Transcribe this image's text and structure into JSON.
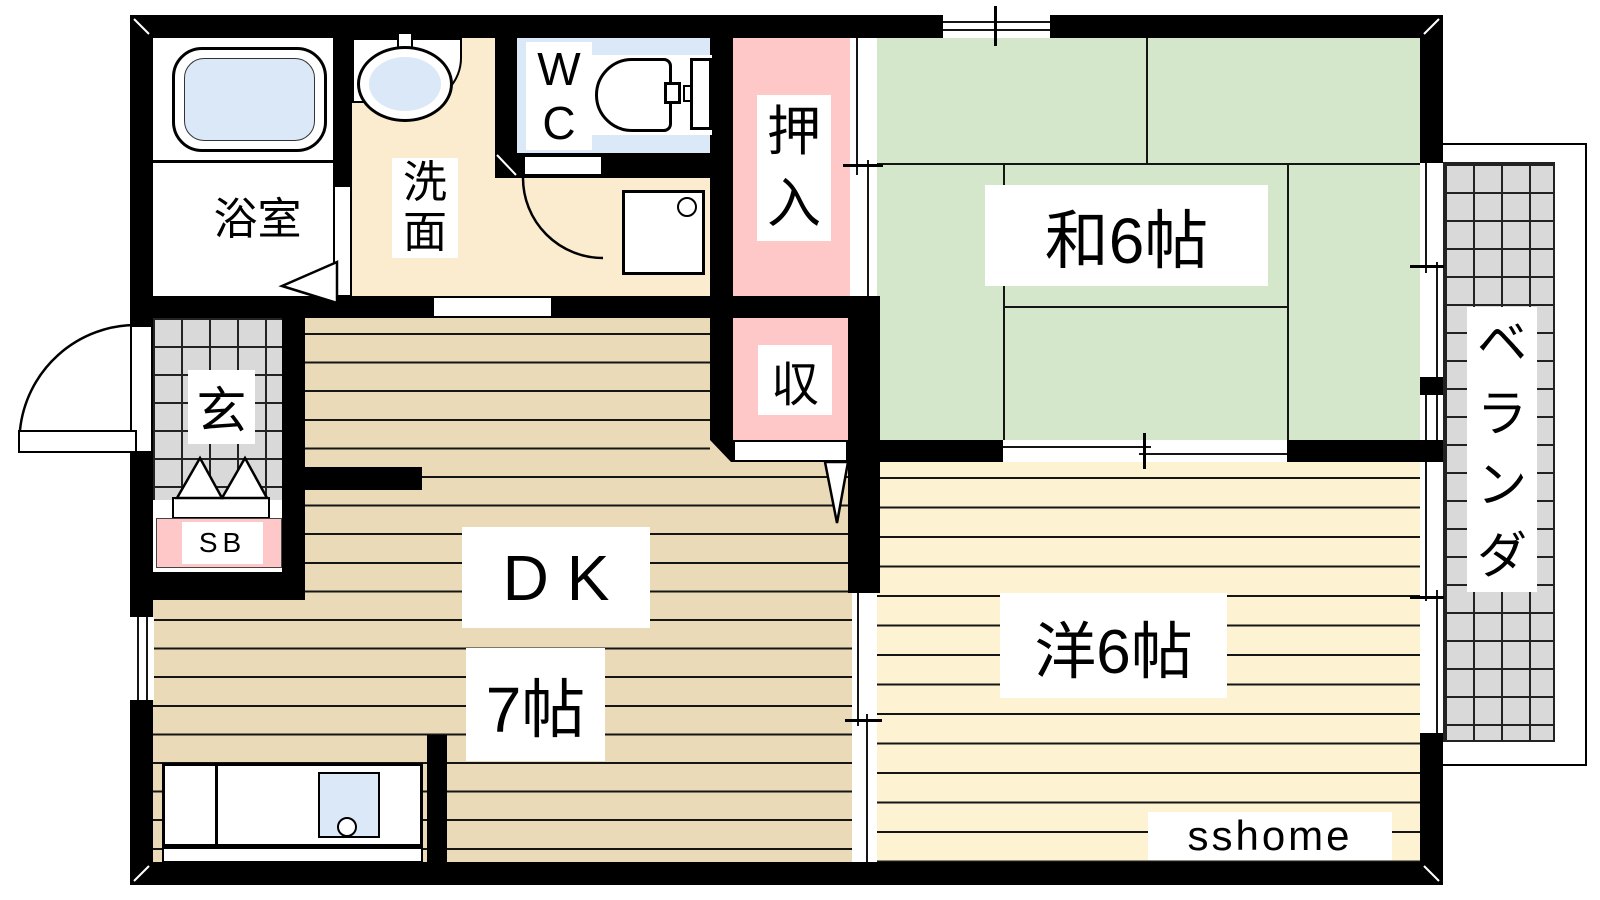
{
  "colors": {
    "wall": "#000000",
    "tatami_green": "#d5e7cb",
    "wood_floor_tan": "#ebdab8",
    "western_room_cream": "#fdf3d2",
    "washroom_cream": "#fbeccf",
    "closet_pink": "#ffc8c8",
    "fixture_blue": "#dbe8f8",
    "tile_grey": "#d9d9d9"
  },
  "rooms": {
    "bathroom": {
      "label": "浴室"
    },
    "washroom": {
      "chars": [
        "洗",
        "面"
      ]
    },
    "toilet": {
      "chars": [
        "W",
        "C"
      ]
    },
    "closet": {
      "chars": [
        "押",
        "入"
      ]
    },
    "storage": {
      "label": "収"
    },
    "entrance": {
      "label": "玄"
    },
    "shoe_box": {
      "label": "SB"
    },
    "japanese_room": {
      "label": "和6帖"
    },
    "dining_kitchen": {
      "label": "DK",
      "size": "7帖"
    },
    "western_room": {
      "label": "洋6帖"
    },
    "veranda": {
      "chars": [
        "ベ",
        "ラ",
        "ン",
        "ダ"
      ]
    }
  },
  "watermark": "sshome"
}
